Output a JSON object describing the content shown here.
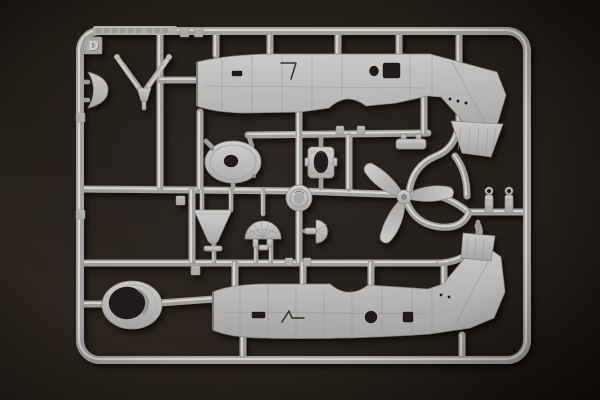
{
  "scene": {
    "type": "photograph",
    "subject": "Light-grey injection-moulded plastic model-kit sprue (parts frame) photographed on a dark brown background",
    "sprue_letter": "D",
    "colors": {
      "background": "#241e1b",
      "background_edge": "#17120f",
      "plastic_base": "#c4c3c1",
      "plastic_highlight": "#e4e4e2",
      "plastic_shadow": "#8b8a88",
      "engraving": "#35302c"
    },
    "parts": [
      {
        "name": "fuselage-half-upper",
        "description": "aircraft fuselage half, nose left, tail fin pointing down-right, cockpit cutouts"
      },
      {
        "name": "fuselage-half-lower",
        "description": "aircraft fuselage half, nose left, tail fin pointing up-right, round porthole"
      },
      {
        "name": "cowling-ring",
        "description": "oval engine cowling ring with open centre"
      },
      {
        "name": "cowling-front-plate",
        "description": "oval disc with centre opening"
      },
      {
        "name": "cooling-fan-dome",
        "description": "ribbed dome cooling fan with mounting legs"
      },
      {
        "name": "spinner-backplate",
        "description": "small circular disc with concentric detail"
      },
      {
        "name": "propeller",
        "description": "three-blade propeller with hub"
      },
      {
        "name": "engine-mount-frame",
        "description": "rectangular frame with oval opening"
      },
      {
        "name": "triangular-hatch",
        "description": "triangular access panel"
      },
      {
        "name": "half-fan-part",
        "description": "small half-disc ribbed part"
      },
      {
        "name": "louvred-panel-upper",
        "description": "trapezoid cowl-flap panel with grooves"
      },
      {
        "name": "louvred-panel-lower",
        "description": "trapezoid cowl-flap panel with grooves"
      },
      {
        "name": "crescent-cowl-lip",
        "description": "curved crescent cowl lip on left rail"
      },
      {
        "name": "antenna-fork",
        "description": "V-shaped forked part, top left"
      },
      {
        "name": "bracket-with-pegs",
        "description": "small bracket with two pegs"
      },
      {
        "name": "eyelet-posts",
        "description": "two cylindrical posts with eyelet tops"
      }
    ]
  }
}
